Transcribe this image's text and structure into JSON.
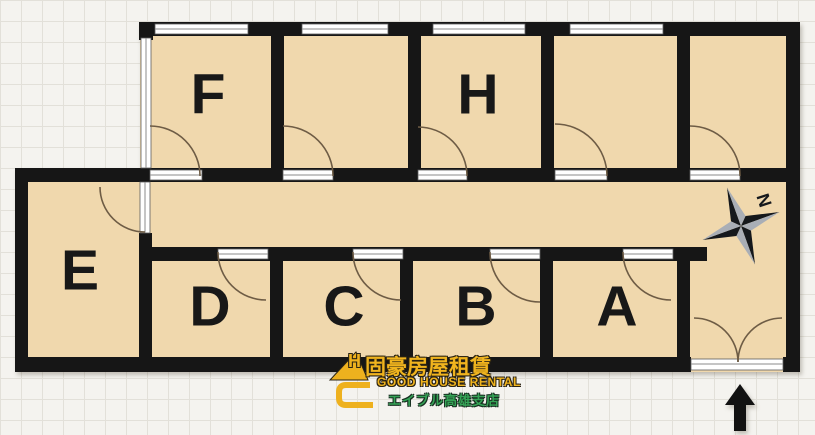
{
  "floorplan": {
    "room_labels": {
      "f": "F",
      "h": "H",
      "e": "E",
      "d": "D",
      "c": "C",
      "b": "B",
      "a": "A"
    },
    "compass": {
      "north_label": "N"
    }
  },
  "logo": {
    "monogram": "H",
    "name_cjk": "固豪房屋租賃",
    "name_en": "GOOD HOUSE RENTAL",
    "branch_jp": "エイブル高雄支店"
  },
  "colors": {
    "room_fill": "#f0d8ad",
    "wall": "#161616",
    "window_white": "#ffffff",
    "door_arc": "#6e5c45",
    "logo_gold": "#f0b41e",
    "logo_green": "#35a356",
    "compass_dark": "#15181c",
    "compass_gray": "#a9aeb6"
  }
}
